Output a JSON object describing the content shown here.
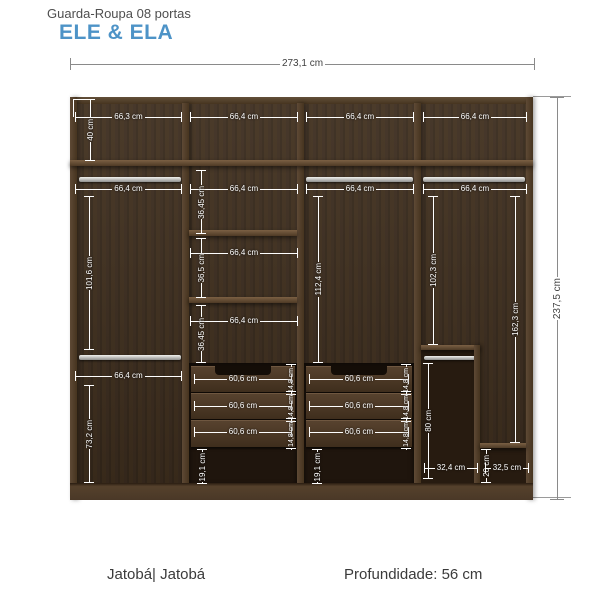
{
  "header": {
    "product_line": "Guarda-Roupa 08 portas",
    "title": "ELE & ELA"
  },
  "footer": {
    "finish": "Jatobá| Jatobá",
    "depth": "Profundidade: 56 cm"
  },
  "colors": {
    "accent_blue": "#4d93c7",
    "wood_dark": "#3e2e20",
    "frame_wood": "#56422d",
    "dim_inner": "#ffffff",
    "dim_outer": "#8a8a8a"
  },
  "dimensions": {
    "total_width": "273,1 cm",
    "total_height": "237,5 cm",
    "top_widths": [
      "66,3 cm",
      "66,4 cm",
      "66,4 cm",
      "66,4 cm"
    ],
    "col1": {
      "top_section_height": "40 cm",
      "rod1_width": "66,4 cm",
      "upper_hang_height": "101,6 cm",
      "rod2_width": "66,4 cm",
      "lower_hang_height": "73,2 cm"
    },
    "col2": {
      "shelf1_width": "66,4 cm",
      "gap1_height": "36,45 cm",
      "shelf2_width": "66,4 cm",
      "gap2_height": "36,5 cm",
      "shelf3_width": "66,4 cm",
      "gap3_height": "36,45 cm",
      "drawer_widths": [
        "60,6 cm",
        "60,6 cm",
        "60,6 cm"
      ],
      "drawer_heights": [
        "14,8 cm",
        "14,8 cm",
        "14,8 cm"
      ],
      "plinth_height": "19,1 cm"
    },
    "col3": {
      "rod_width": "66,4 cm",
      "hang_height": "112,4 cm",
      "drawer_widths": [
        "60,6 cm",
        "60,6 cm",
        "60,6 cm"
      ],
      "drawer_heights": [
        "14,8 cm",
        "14,8 cm",
        "14,8 cm"
      ],
      "plinth_height": "19,1 cm"
    },
    "col4": {
      "rod_width": "66,4 cm",
      "hang_height": "102,3 cm",
      "full_height": "162,3 cm",
      "boot_height": "80 cm",
      "boot_width": "32,4 cm",
      "shelf_gap_height": "20 cm",
      "shelf_width": "32,5 cm"
    }
  }
}
